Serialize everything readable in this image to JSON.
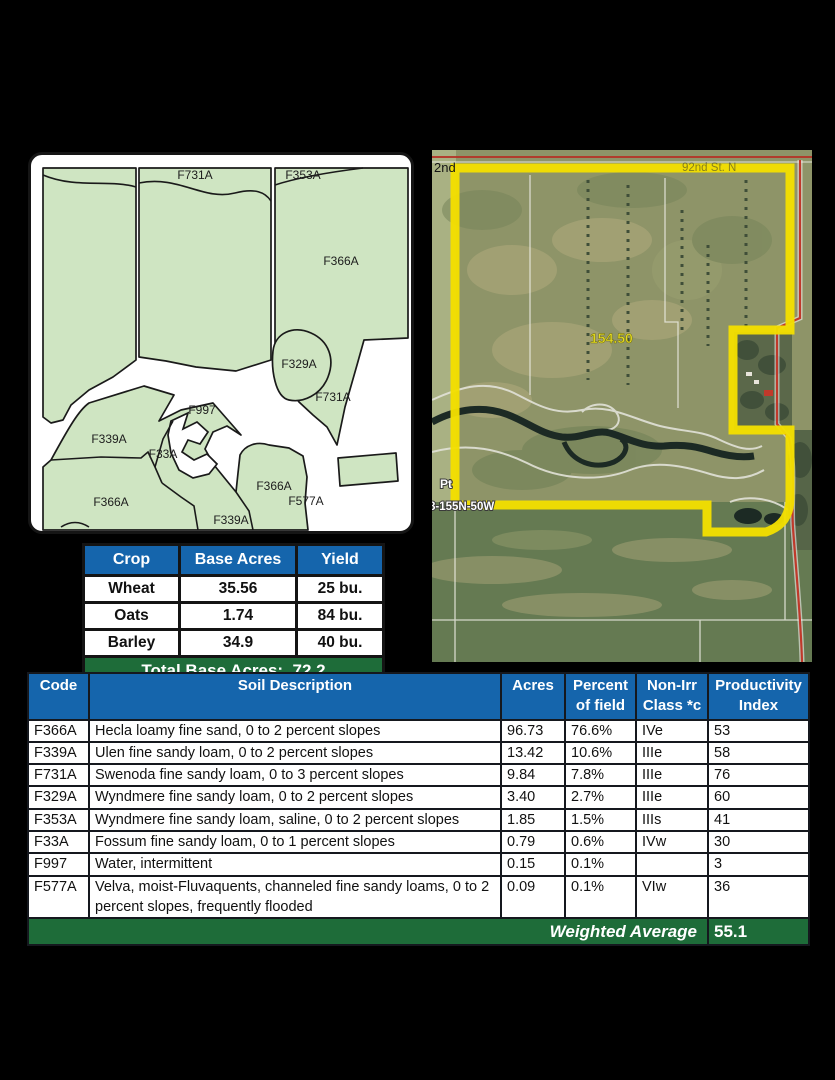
{
  "page": {
    "background": "#000000"
  },
  "soil_map": {
    "polygon_fill": "#cfe5c2",
    "outline_color": "#1a1a1a",
    "labels": [
      "F731A",
      "F353A",
      "F366A",
      "F329A",
      "F731A",
      "F997",
      "F339A",
      "F33A",
      "F366A",
      "F339A",
      "F366A",
      "F577A"
    ]
  },
  "aerial": {
    "boundary_color": "#f2df00",
    "street_label_left": "2nd",
    "street_label_top": "92nd St. N",
    "acres_label": "154.50",
    "point_label": "Pt",
    "section_label": "8-155N-50W"
  },
  "crop_table": {
    "header_color": "#1565ac",
    "total_color": "#1e6c39",
    "headers": [
      "Crop",
      "Base Acres",
      "Yield"
    ],
    "rows": [
      [
        "Wheat",
        "35.56",
        "25 bu."
      ],
      [
        "Oats",
        "1.74",
        "84 bu."
      ],
      [
        "Barley",
        "34.9",
        "40 bu."
      ]
    ],
    "total_label": "Total Base Acres:",
    "total_value": "72.2"
  },
  "soil_table": {
    "header_color": "#1565ac",
    "footer_color": "#1e6c39",
    "headers": [
      "Code",
      "Soil Description",
      "Acres",
      "Percent of field",
      "Non-Irr Class *c",
      "Productivity Index"
    ],
    "rows": [
      [
        "F366A",
        "Hecla loamy fine sand, 0 to 2 percent slopes",
        "96.73",
        "76.6%",
        "IVe",
        "53"
      ],
      [
        "F339A",
        "Ulen fine sandy loam, 0 to 2 percent slopes",
        "13.42",
        "10.6%",
        "IIIe",
        "58"
      ],
      [
        "F731A",
        "Swenoda fine sandy loam, 0 to 3 percent slopes",
        "9.84",
        "7.8%",
        "IIIe",
        "76"
      ],
      [
        "F329A",
        "Wyndmere fine sandy loam, 0 to 2 percent slopes",
        "3.40",
        "2.7%",
        "IIIe",
        "60"
      ],
      [
        "F353A",
        "Wyndmere fine sandy loam, saline, 0 to 2 percent slopes",
        "1.85",
        "1.5%",
        "IIIs",
        "41"
      ],
      [
        "F33A",
        "Fossum fine sandy loam, 0 to 1 percent slopes",
        "0.79",
        "0.6%",
        "IVw",
        "30"
      ],
      [
        "F997",
        "Water, intermittent",
        "0.15",
        "0.1%",
        "",
        "3"
      ],
      [
        "F577A",
        "Velva, moist-Fluvaquents, channeled fine sandy loams, 0 to 2 percent slopes, frequently flooded",
        "0.09",
        "0.1%",
        "VIw",
        "36"
      ]
    ],
    "footer_label": "Weighted Average",
    "footer_value": "55.1"
  }
}
